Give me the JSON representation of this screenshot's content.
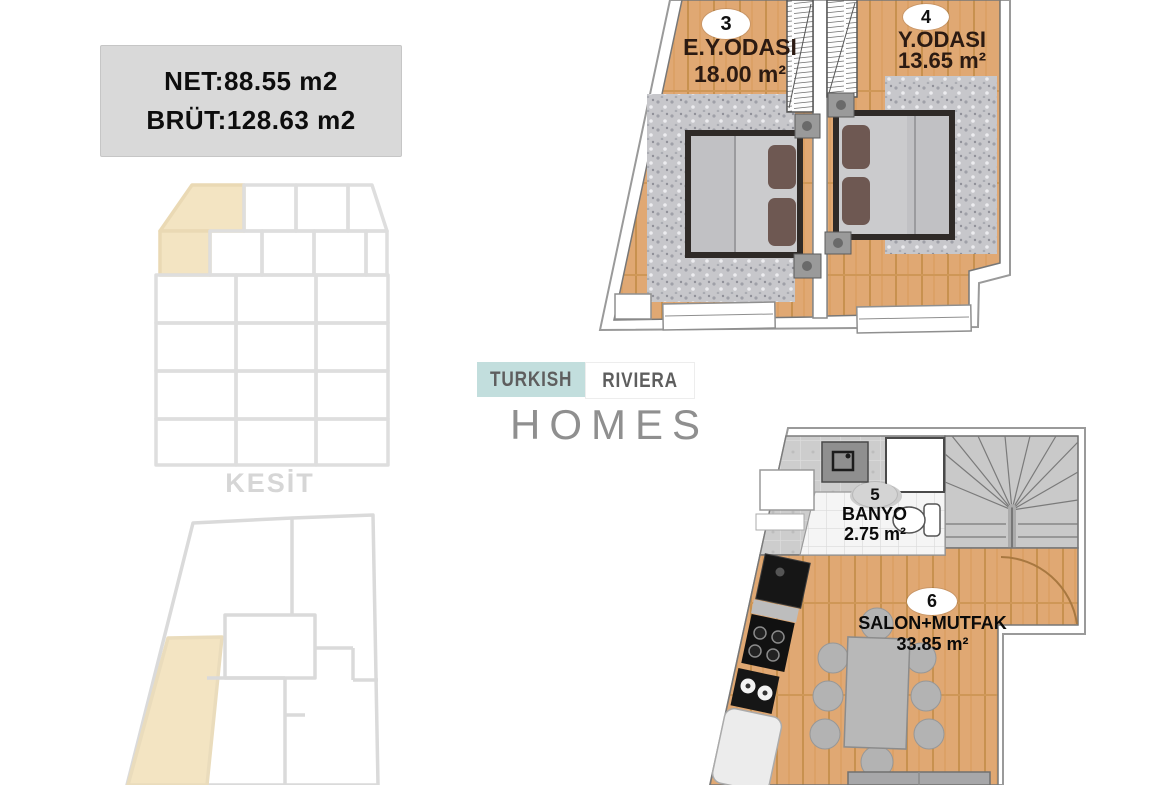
{
  "info_box": {
    "net": "NET:88.55 m2",
    "brut": "BRÜT:128.63 m2"
  },
  "section_diagram": {
    "label": "KESİT",
    "highlight_color": "#f3e4c2"
  },
  "key_plan": {
    "highlight_color": "#f3e4c2"
  },
  "logo": {
    "word1": "TURKISH",
    "word2": "RIVIERA",
    "word3": "HOMES"
  },
  "upper_plan": {
    "rooms": [
      {
        "number": "3",
        "name": "E.Y.ODASI",
        "area": "18.00 m²"
      },
      {
        "number": "4",
        "name": "Y.ODASI",
        "area": "13.65 m²"
      }
    ]
  },
  "lower_plan": {
    "rooms": [
      {
        "number": "5",
        "name": "BANYO",
        "area": "2.75 m²"
      },
      {
        "number": "6",
        "name": "SALON+MUTFAK",
        "area": "33.85 m²"
      }
    ]
  },
  "colors": {
    "wood": "#e0a873",
    "carpet": "#c7c7cb",
    "tile": "#cdcdcd",
    "beige": "#f3e4c2",
    "accent": "#c2dedd",
    "info_bg": "#d9d9d9",
    "faint": "#d6d6d6"
  }
}
